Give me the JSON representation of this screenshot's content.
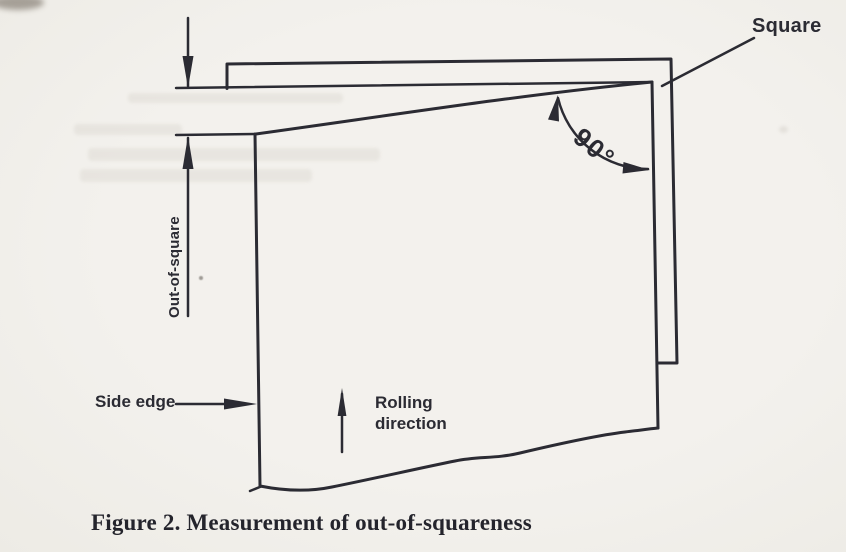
{
  "figure": {
    "caption": "Figure 2. Measurement of out-of-squareness",
    "labels": {
      "square": "Square",
      "angle": "90°",
      "out_of_square": "Out-of-square",
      "side_edge": "Side edge",
      "rolling_direction": "Rolling direction"
    },
    "colors": {
      "ink": "#2b2b33",
      "paper": "#f0eee9"
    }
  }
}
